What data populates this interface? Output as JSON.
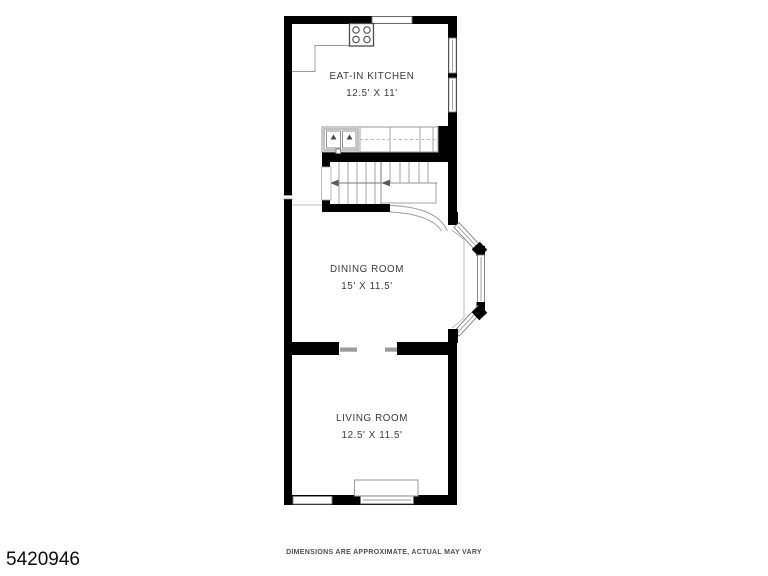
{
  "rooms": [
    {
      "name": "EAT-IN KITCHEN",
      "dimensions": "12.5' X 11'"
    },
    {
      "name": "DINING ROOM",
      "dimensions": "15' X 11.5'"
    },
    {
      "name": "LIVING ROOM",
      "dimensions": "12.5' X 11.5'"
    }
  ],
  "footer": {
    "id_number": "5420946",
    "disclaimer": "DIMENSIONS ARE APPROXIMATE, ACTUAL MAY VARY"
  },
  "fixtures": [
    "stove-icon",
    "double-sink-icon",
    "kitchen-counter",
    "staircase",
    "stair-direction-arrows",
    "under-stair-arch",
    "bay-window",
    "double-hung-windows",
    "box-bay-window",
    "room-opening"
  ],
  "colors": {
    "wall": "#000000",
    "thin_line": "#9a9a9a",
    "label_text": "#3a3a3a",
    "background": "#ffffff"
  }
}
